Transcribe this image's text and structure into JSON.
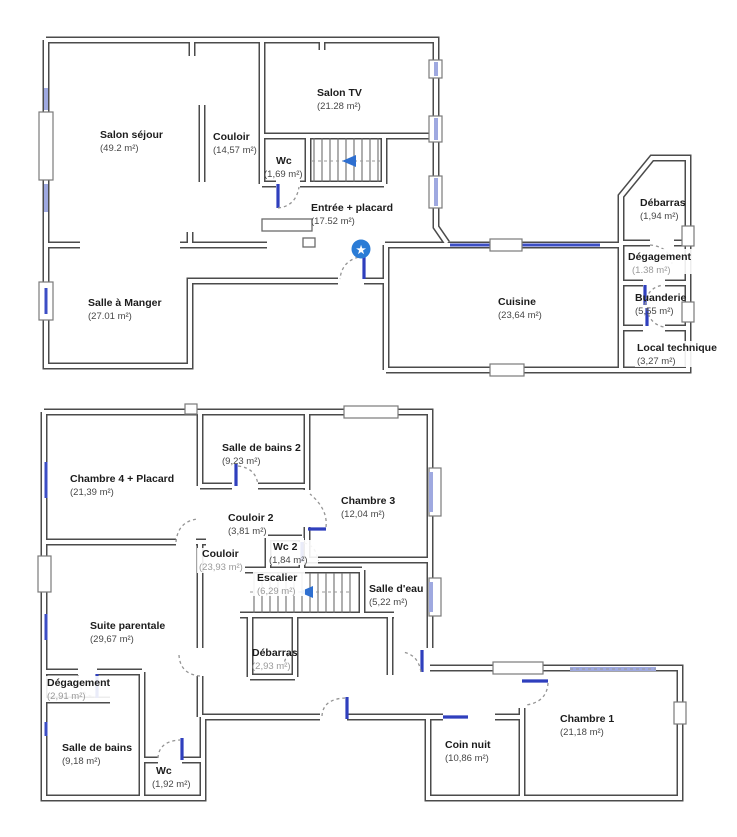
{
  "document": {
    "type": "floor-plan-drawing",
    "floor_count": 2
  },
  "colors": {
    "wall": "#4b4b4b",
    "window_blue": "#3c4ec5",
    "window_pale": "#9fa9e0",
    "door_dash": "#949494",
    "door_leaf_blue": "#2f3fbd",
    "marker_blue": "#2b7cd6",
    "stair_arrow_blue": "#2e6fd0",
    "room_name_text": "#1c1c1c",
    "room_area_text": "#474747",
    "room_area_text_light": "#9a9a9a"
  },
  "icons": {
    "star_marker": "★"
  },
  "floors": [
    {
      "name": "ground-floor",
      "rooms": [
        {
          "name": "Salon séjour",
          "area": "(49.2 m²)"
        },
        {
          "name": "Couloir",
          "area": "(14,57 m²)"
        },
        {
          "name": "Salon TV",
          "area": "(21.28 m²)"
        },
        {
          "name": "Wc",
          "area": "(1,69 m²)"
        },
        {
          "name": "Entrée + placard",
          "area": "(17.52 m²)"
        },
        {
          "name": "Salle à Manger",
          "area": "(27.01 m²)"
        },
        {
          "name": "Cuisine",
          "area": "(23,64 m²)"
        },
        {
          "name": "Débarras",
          "area": "(1,94 m²)"
        },
        {
          "name": "Dégagement",
          "area": "(1.38 m²)"
        },
        {
          "name": "Buanderie",
          "area": "(5,55 m²)"
        },
        {
          "name": "Local technique",
          "area": "(3,27 m²)"
        }
      ]
    },
    {
      "name": "first-floor",
      "rooms": [
        {
          "name": "Chambre 4 + Placard",
          "area": "(21,39 m²)"
        },
        {
          "name": "Salle de bains 2",
          "area": "(9,23 m²)"
        },
        {
          "name": "Chambre 3",
          "area": "(12,04 m²)"
        },
        {
          "name": "Couloir 2",
          "area": "(3,81 m²)"
        },
        {
          "name": "Wc 2",
          "area": "(1,84 m²)"
        },
        {
          "name": "Couloir",
          "area": "(23,93 m²)"
        },
        {
          "name": "Escalier",
          "area": "(6,29 m²)"
        },
        {
          "name": "Salle d'eau",
          "area": "(5,22 m²)"
        },
        {
          "name": "Débarras",
          "area": "(2,93 m²)"
        },
        {
          "name": "Suite parentale",
          "area": "(29,67 m²)"
        },
        {
          "name": "Dégagement",
          "area": "(2,91 m²)"
        },
        {
          "name": "Salle de bains",
          "area": "(9,18 m²)"
        },
        {
          "name": "Wc",
          "area": "(1,92 m²)"
        },
        {
          "name": "Coin nuit",
          "area": "(10,86 m²)"
        },
        {
          "name": "Chambre 1",
          "area": "(21,18 m²)"
        }
      ]
    }
  ]
}
